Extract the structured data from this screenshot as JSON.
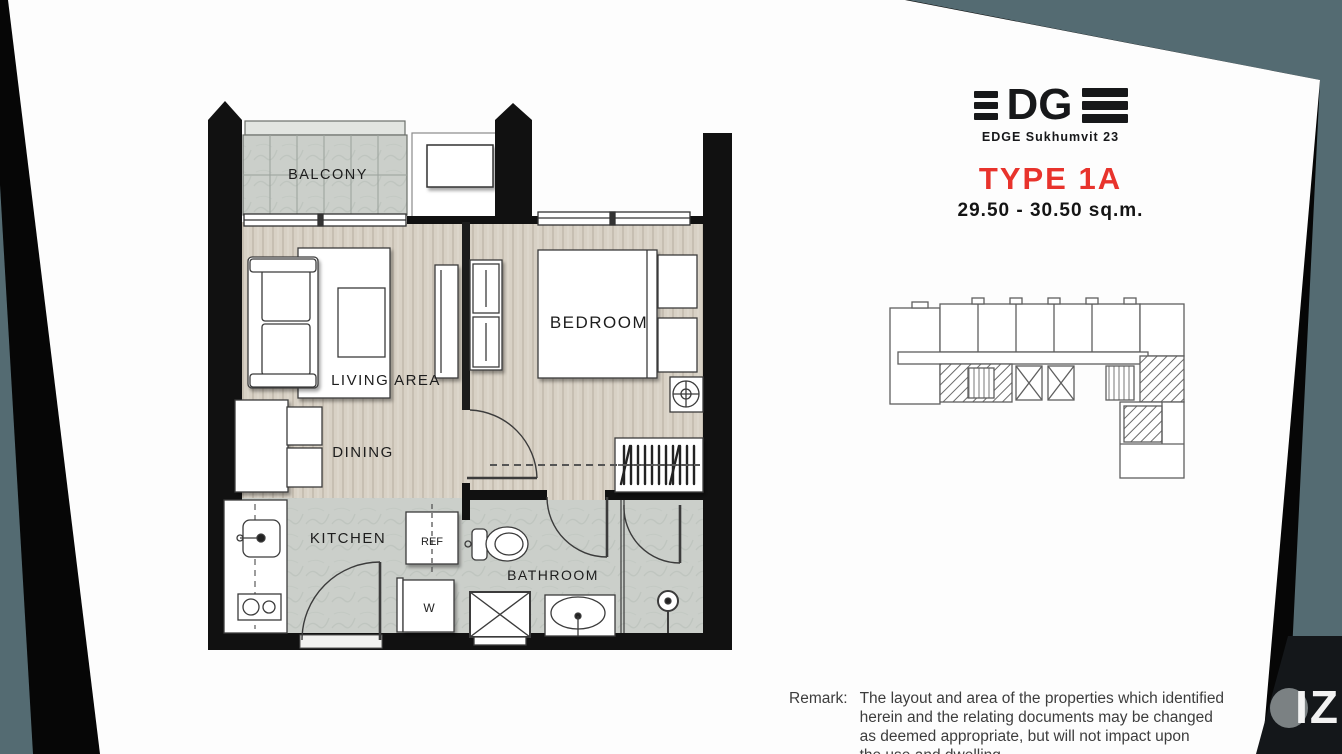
{
  "header": {
    "logo_subtitle": "EDGE Sukhumvit 23",
    "unit_type": "TYPE 1A",
    "unit_area": "29.50 - 30.50 sq.m."
  },
  "floorplan": {
    "labels": {
      "balcony": "BALCONY",
      "living": "LIVING AREA",
      "dining": "DINING",
      "bedroom": "BEDROOM",
      "kitchen": "KITCHEN",
      "bathroom": "BATHROOM",
      "fridge": "REF",
      "washer": "W"
    }
  },
  "remark": {
    "label": "Remark:",
    "lines": [
      "The layout and area of the properties which identified",
      "herein and the relating documents may be changed",
      "as deemed appropriate, but will not impact upon",
      "the use and dwelling"
    ]
  },
  "watermark": {
    "text": "IZ"
  },
  "colors": {
    "accent_red": "#e8332c",
    "backdrop_teal": "#546b72",
    "wall_black": "#111111",
    "floor_beige": "#d8d1c5",
    "floor_gray": "#cbcfca"
  }
}
